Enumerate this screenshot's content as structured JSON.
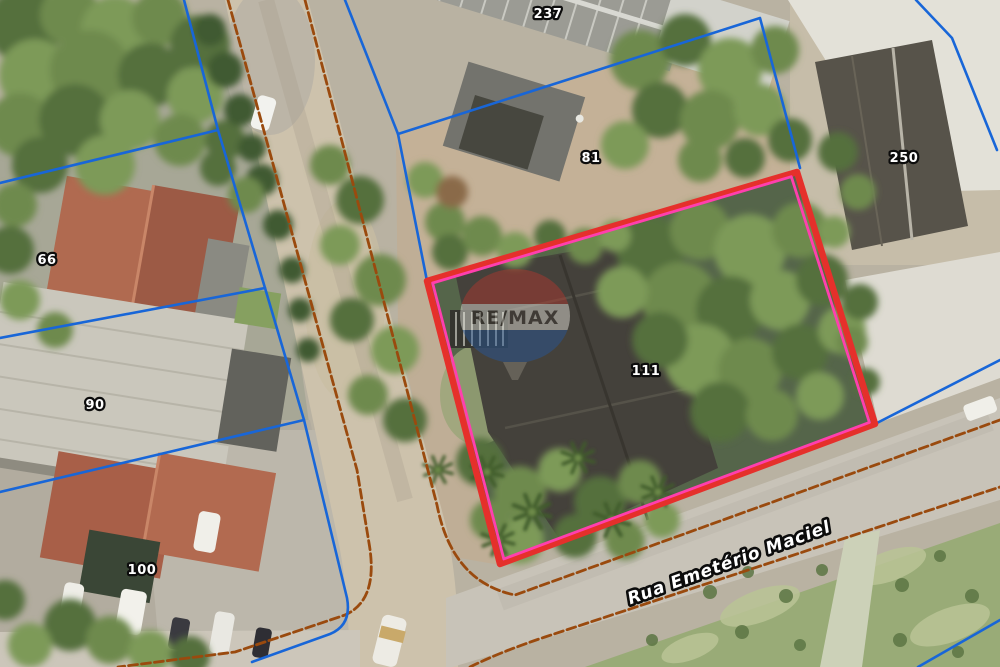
{
  "map": {
    "street_label": "Rua Emetério Maciel",
    "watermark_label": "RE/MAX",
    "lot_labels": [
      "237",
      "81",
      "250",
      "66",
      "90",
      "100",
      "111"
    ],
    "colors": {
      "lot_boundary_blue": "#1866d8",
      "road_edge_orange": "#a14f10",
      "property_outline_red": "#e5302b",
      "property_inner_pink": "#ff3fae"
    }
  }
}
